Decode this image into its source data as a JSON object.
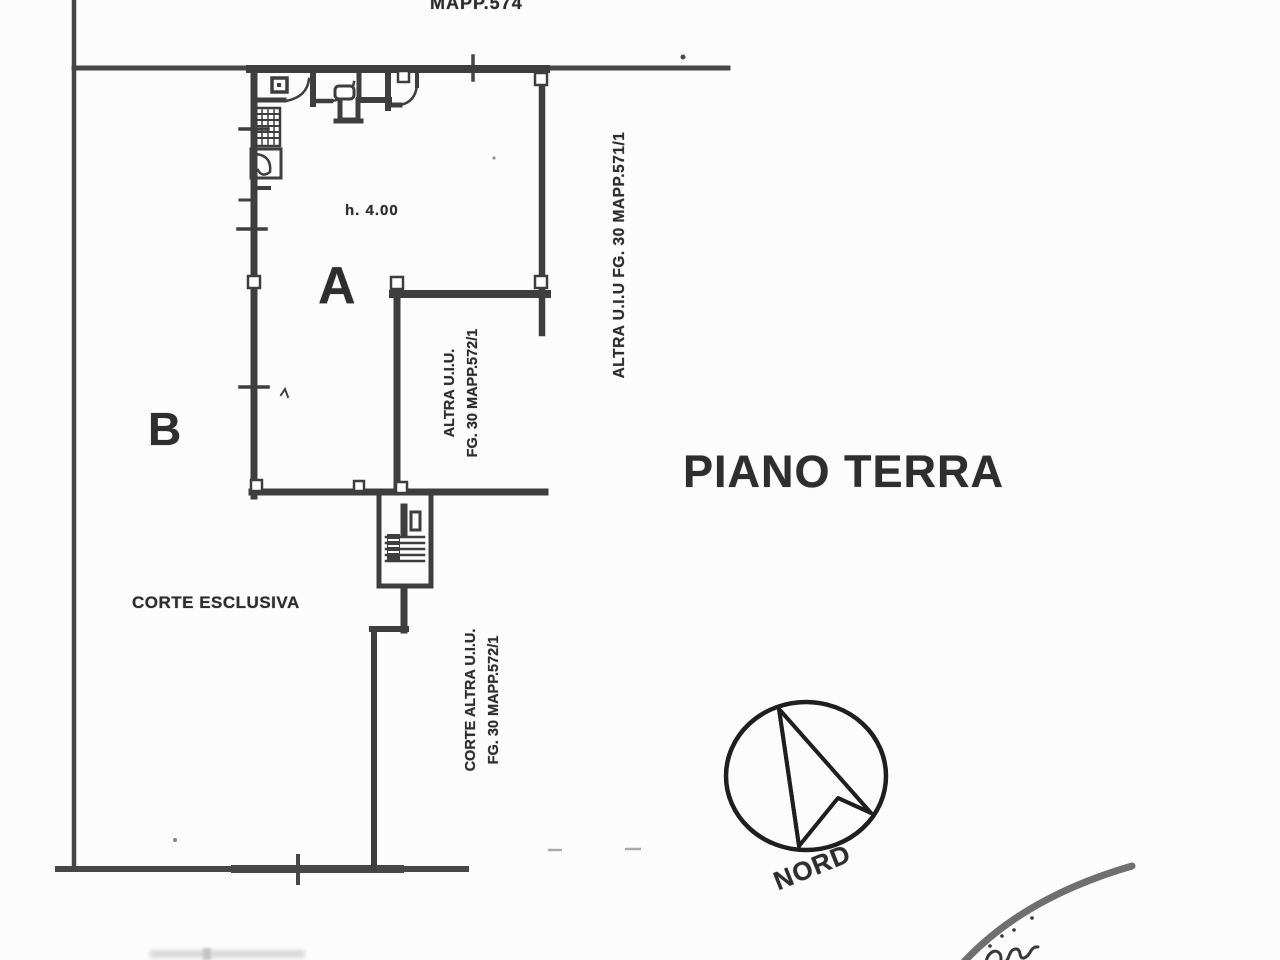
{
  "plan": {
    "title": "PIANO TERRA",
    "top_parcel": "MAPP.574",
    "room_a": "A",
    "room_b": "B",
    "height_note": "h. 4.00",
    "courtyard": "CORTE ESCLUSIVA",
    "north_label": "NORD",
    "neighbor_right": "ALTRA U.I.U  FG. 30 MAPP.571/1",
    "neighbor_inner": {
      "line1": "ALTRA U.I.U.",
      "line2": "FG. 30 MAPP.572/1"
    },
    "neighbor_court": {
      "line1": "CORTE ALTRA U.I.U.",
      "line2": "FG. 30 MAPP.572/1"
    }
  },
  "colors": {
    "paper": "#fcfcfc",
    "ink": "#2e2e2e",
    "wall": "#3e3e3e",
    "boundary": "#474747",
    "stamp": "#6f6f6f"
  }
}
